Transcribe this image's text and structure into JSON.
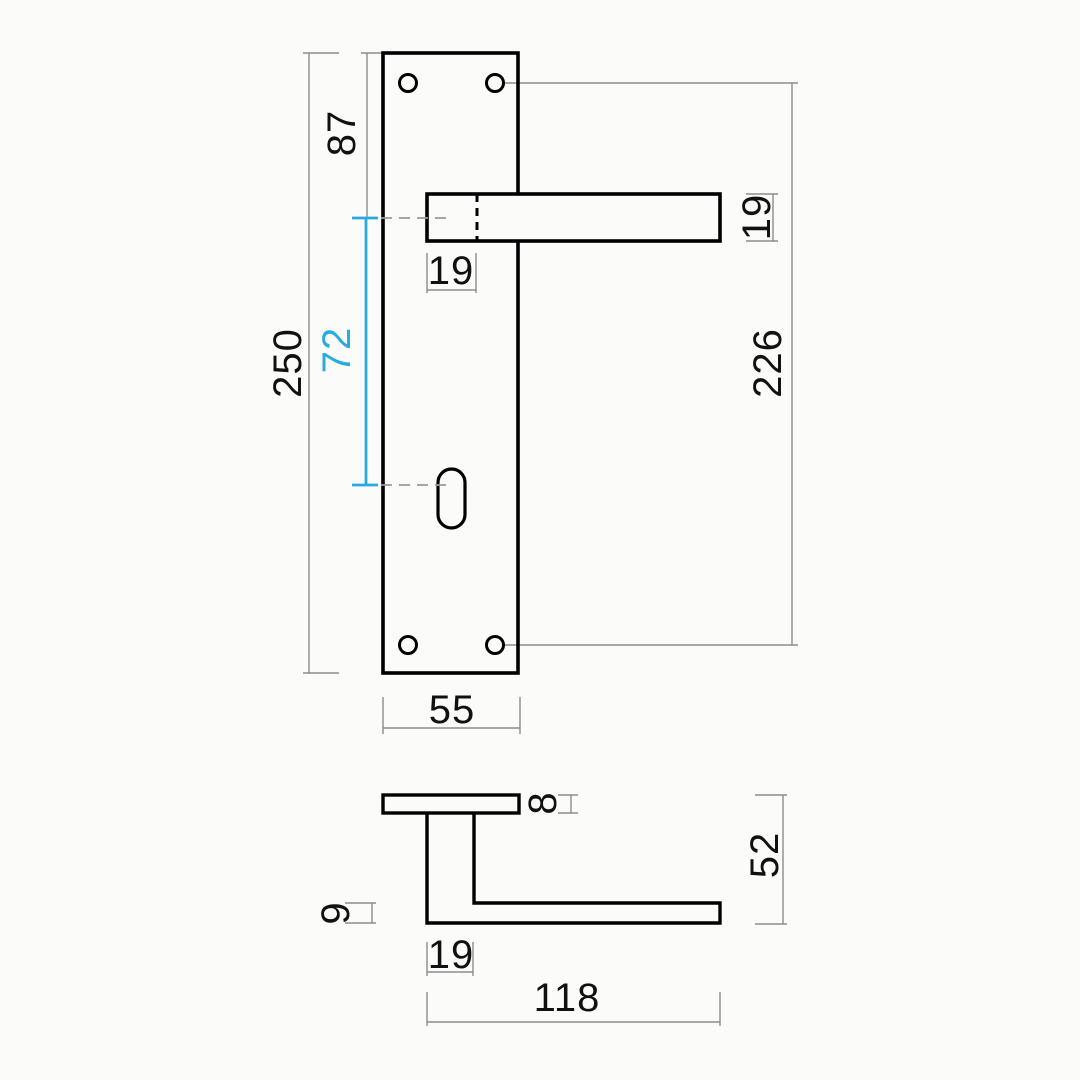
{
  "drawing": {
    "type": "technical-dimension-drawing",
    "subject": "door handle with long backplate, front view and side profile",
    "colors": {
      "outline": "#000000",
      "dimension_lines": "#8c8c8c",
      "accent": "#29abe2",
      "background": "#fbfbf9"
    }
  },
  "views": {
    "front": {
      "name": "front view - lever handle on backplate",
      "dimensions": {
        "plate_height": "250",
        "plate_top_to_handle_center": "87",
        "handle_to_keyhole_center": "72",
        "spindle_inset": "19",
        "lever_section_height": "19",
        "screw_hole_spacing": "226",
        "plate_width": "55"
      }
    },
    "side": {
      "name": "side profile view",
      "dimensions": {
        "plate_thickness": "8",
        "lever_arm_thickness": "9",
        "total_projection": "52",
        "neck_section_width": "19",
        "handle_length": "118"
      }
    }
  }
}
